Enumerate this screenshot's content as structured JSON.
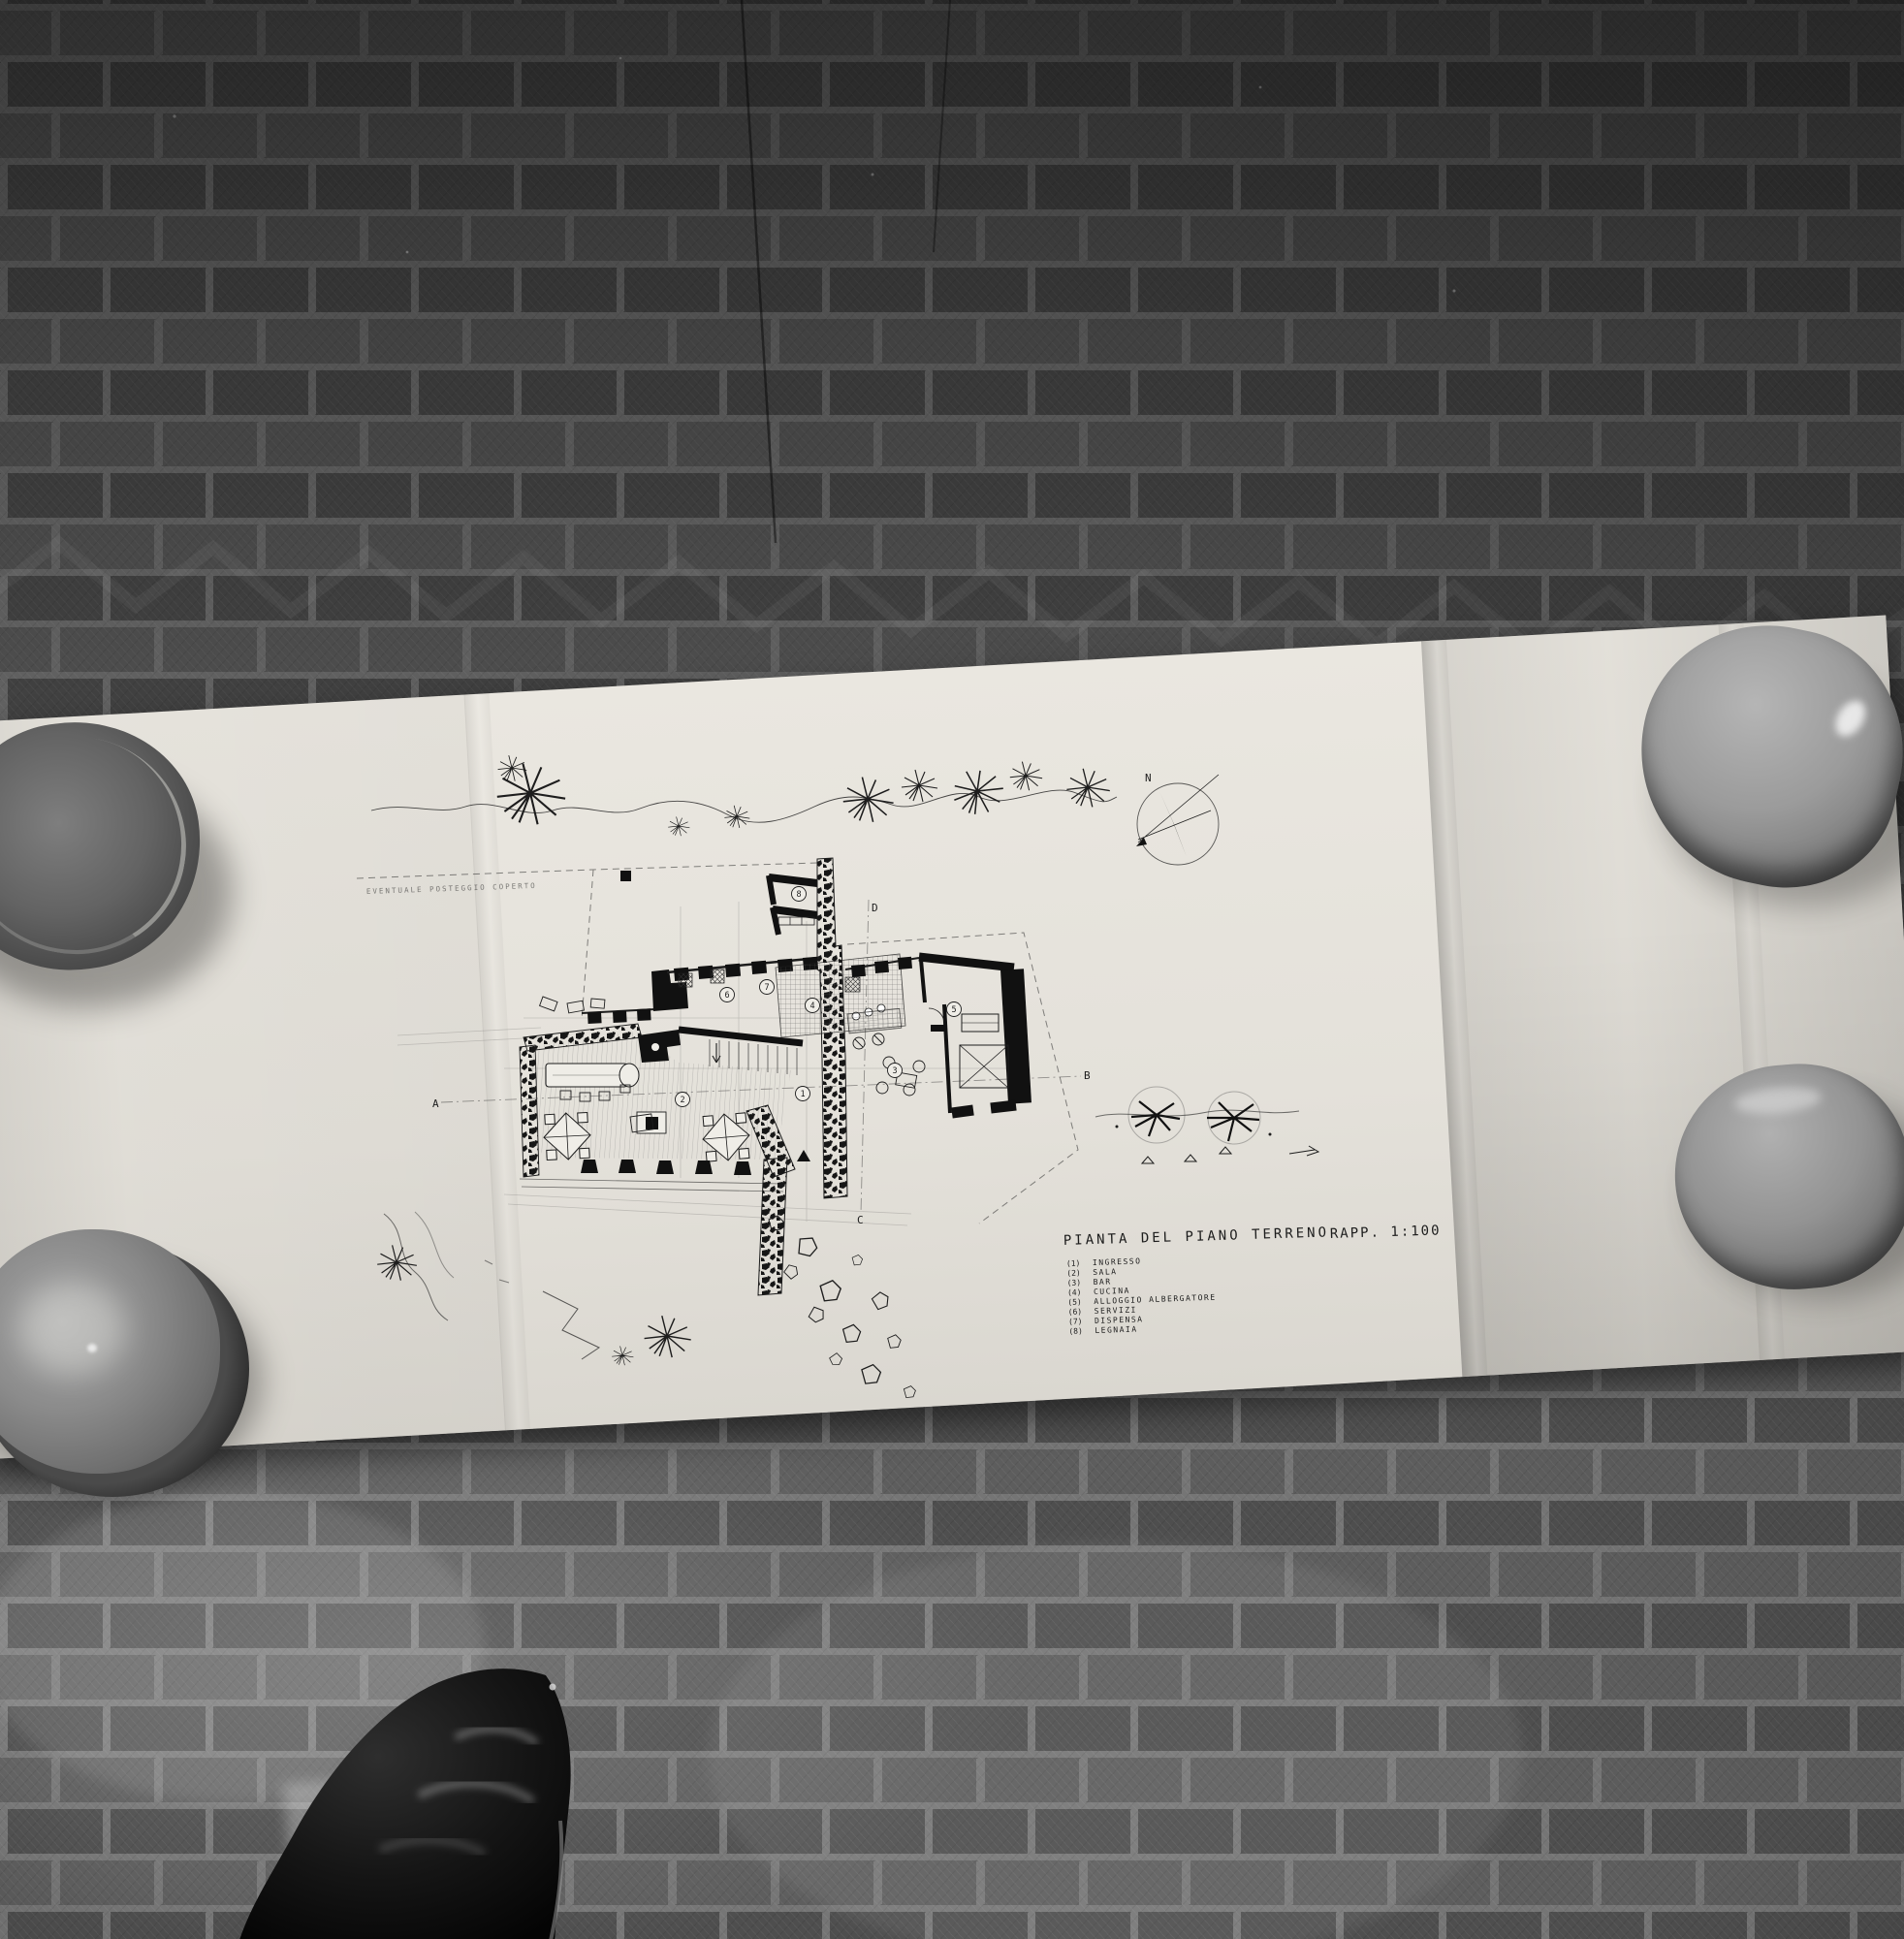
{
  "drawing": {
    "title": "PIANTA DEL PIANO TERRENO",
    "scale_label": "RAPP. 1:100",
    "site_note": "EVENTUALE POSTEGGIO COPERTO",
    "compass_label": "N",
    "markers": {
      "a": "A",
      "b": "B",
      "c": "C",
      "d": "D"
    },
    "rooms": [
      {
        "num": "(1)",
        "id": "1",
        "label": "INGRESSO"
      },
      {
        "num": "(2)",
        "id": "2",
        "label": "SALA"
      },
      {
        "num": "(3)",
        "id": "3",
        "label": "BAR"
      },
      {
        "num": "(4)",
        "id": "4",
        "label": "CUCINA"
      },
      {
        "num": "(5)",
        "id": "5",
        "label": "ALLOGGIO ALBERGATORE"
      },
      {
        "num": "(6)",
        "id": "6",
        "label": "SERVIZI"
      },
      {
        "num": "(7)",
        "id": "7",
        "label": "DISPENSA"
      },
      {
        "num": "(8)",
        "id": "8",
        "label": "LEGNAIA"
      }
    ]
  },
  "scene": {
    "objects": [
      "herringbone-parquet-floor",
      "folded-plan-sheet",
      "ceramic-bowl-paperweights",
      "leather-shoe-toe"
    ],
    "palette": {
      "floor_dark": "#3f3f3f",
      "floor_light": "#8d8d8d",
      "paper": "#e7e4dd",
      "bowl_gray": "#8a8a8a",
      "shoe_black": "#0c0c0c",
      "ink": "#1d1d1d"
    }
  }
}
